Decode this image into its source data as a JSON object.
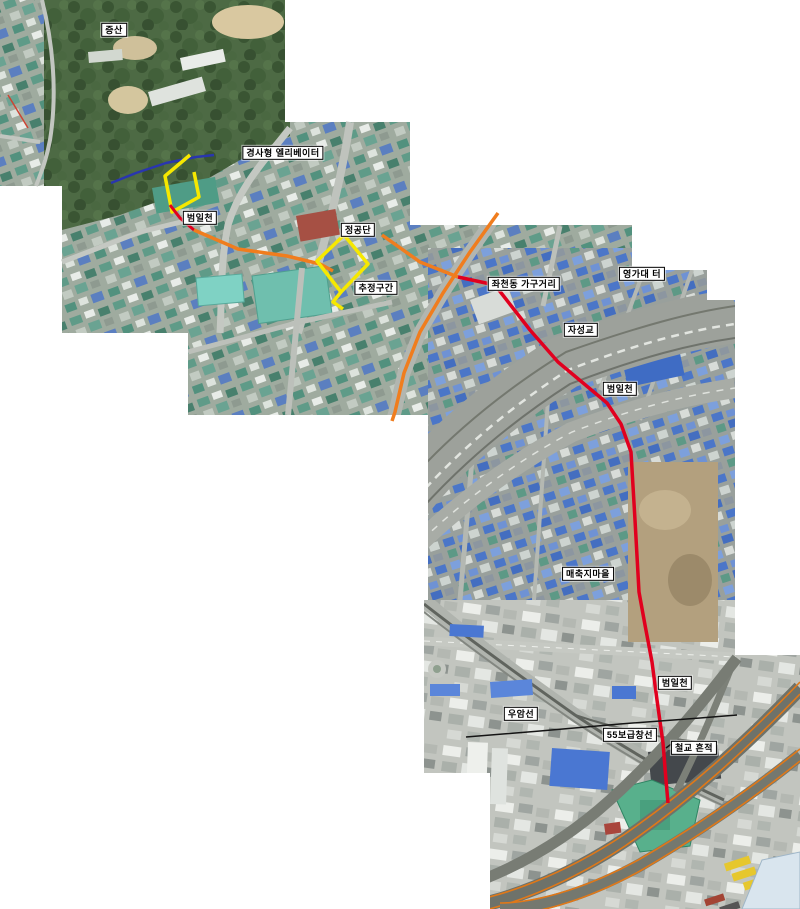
{
  "map": {
    "kind": "aerial-photo-collage",
    "description_labels_language": "ko",
    "canvas": {
      "width": 800,
      "height": 909,
      "background": "#ffffff"
    }
  },
  "colors": {
    "red_line": "#e1001e",
    "orange_line": "#f07d1e",
    "yellow_line": "#f6e800",
    "blue_line": "#2936ae",
    "black_line": "#141414",
    "label_bg": "#ffffff",
    "label_border": "#000000",
    "label_text": "#000000"
  },
  "labels": [
    {
      "id": "jeungsan",
      "text": "증산",
      "x": 114,
      "y": 30
    },
    {
      "id": "incline-elevator",
      "text": "경사형 엘리베이터",
      "x": 283,
      "y": 153
    },
    {
      "id": "beomilcheon-upper",
      "text": "범일천",
      "x": 200,
      "y": 218
    },
    {
      "id": "jeonggongdan",
      "text": "정공단",
      "x": 358,
      "y": 230
    },
    {
      "id": "estimated-section",
      "text": "추정구간",
      "x": 376,
      "y": 288
    },
    {
      "id": "jwacheon-furniture",
      "text": "좌천동 가구거리",
      "x": 524,
      "y": 284
    },
    {
      "id": "yeonggadae-site",
      "text": "영가대 터",
      "x": 642,
      "y": 274
    },
    {
      "id": "jaseong-bridge",
      "text": "자성교",
      "x": 581,
      "y": 330
    },
    {
      "id": "beomilcheon-middle",
      "text": "범일천",
      "x": 620,
      "y": 389
    },
    {
      "id": "maechukji-village",
      "text": "매축지마을",
      "x": 588,
      "y": 574
    },
    {
      "id": "beomilcheon-lower",
      "text": "범일천",
      "x": 675,
      "y": 683
    },
    {
      "id": "uam-line",
      "text": "우암선",
      "x": 521,
      "y": 714
    },
    {
      "id": "supply-depot-55-line",
      "text": "55보급창선",
      "x": 630,
      "y": 735
    },
    {
      "id": "rail-bridge-trace",
      "text": "철교 흔적",
      "x": 694,
      "y": 748
    }
  ],
  "routes": [
    {
      "id": "blue-estimated-stream",
      "color": "#2936ae",
      "width": 2.5,
      "points": [
        [
          111,
          183
        ],
        [
          136,
          173
        ],
        [
          166,
          163
        ],
        [
          196,
          157
        ],
        [
          214,
          155
        ]
      ]
    },
    {
      "id": "yellow-elevator-section",
      "color": "#f6e800",
      "width": 3.5,
      "points": [
        [
          190,
          155
        ],
        [
          165,
          176
        ],
        [
          172,
          212
        ],
        [
          199,
          197
        ],
        [
          194,
          172
        ]
      ]
    },
    {
      "id": "red-stream-upper",
      "color": "#e1001e",
      "width": 3,
      "points": [
        [
          170,
          205
        ],
        [
          180,
          218
        ],
        [
          194,
          230
        ]
      ]
    },
    {
      "id": "orange-covered-upper",
      "color": "#f07d1e",
      "width": 3.5,
      "points": [
        [
          194,
          230
        ],
        [
          238,
          249
        ],
        [
          287,
          256
        ],
        [
          320,
          264
        ],
        [
          333,
          271
        ]
      ]
    },
    {
      "id": "yellow-jeonggongdan-loop",
      "color": "#f6e800",
      "width": 3.5,
      "points": [
        [
          344,
          235
        ],
        [
          317,
          261
        ],
        [
          341,
          292
        ],
        [
          368,
          264
        ],
        [
          344,
          235
        ]
      ]
    },
    {
      "id": "yellow-loop-tail",
      "color": "#f6e800",
      "width": 3.5,
      "points": [
        [
          341,
          292
        ],
        [
          333,
          302
        ],
        [
          343,
          309
        ]
      ]
    },
    {
      "id": "orange-road-section",
      "color": "#f07d1e",
      "width": 3.5,
      "points": [
        [
          498,
          213
        ],
        [
          470,
          252
        ],
        [
          443,
          293
        ],
        [
          420,
          332
        ],
        [
          404,
          373
        ],
        [
          395,
          412
        ],
        [
          392,
          421
        ]
      ]
    },
    {
      "id": "orange-cross-section",
      "color": "#f07d1e",
      "width": 3.5,
      "points": [
        [
          382,
          235
        ],
        [
          420,
          262
        ],
        [
          458,
          277
        ]
      ]
    },
    {
      "id": "red-stream-main",
      "color": "#e1001e",
      "width": 3.5,
      "points": [
        [
          458,
          277
        ],
        [
          495,
          285
        ],
        [
          530,
          330
        ],
        [
          558,
          362
        ],
        [
          607,
          403
        ],
        [
          621,
          424
        ],
        [
          631,
          452
        ],
        [
          635,
          520
        ],
        [
          639,
          592
        ],
        [
          645,
          625
        ],
        [
          652,
          662
        ],
        [
          657,
          700
        ],
        [
          663,
          743
        ],
        [
          666,
          780
        ],
        [
          668,
          803
        ]
      ]
    },
    {
      "id": "black-55-supply-line",
      "color": "#141414",
      "width": 1.5,
      "points": [
        [
          466,
          737
        ],
        [
          540,
          731
        ],
        [
          620,
          724
        ],
        [
          700,
          718
        ],
        [
          737,
          715
        ]
      ]
    },
    {
      "id": "rail-bridge-tick",
      "color": "#141414",
      "width": 1.5,
      "points": [
        [
          666,
          748
        ],
        [
          674,
          742
        ]
      ]
    }
  ]
}
